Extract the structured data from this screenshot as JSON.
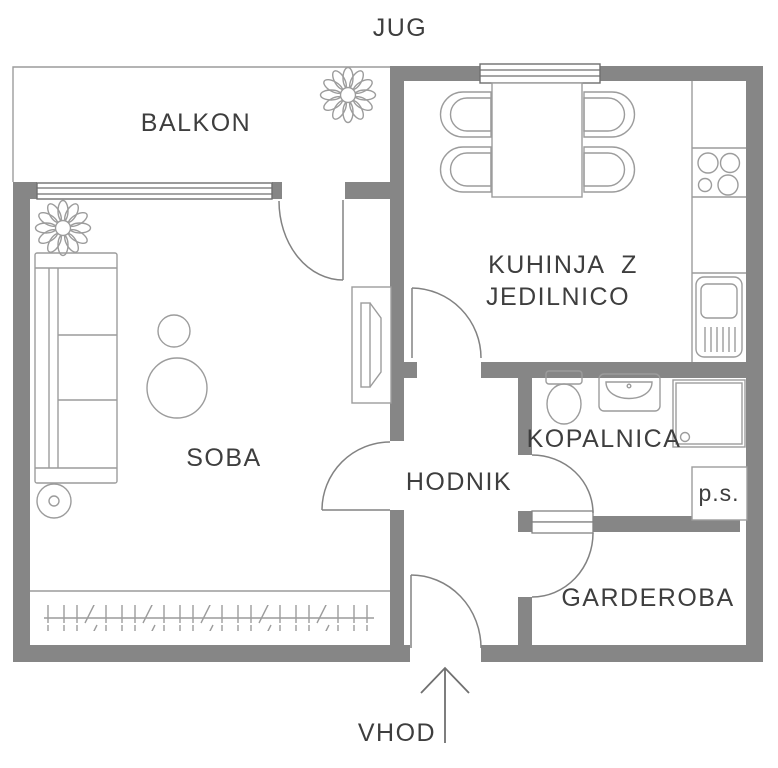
{
  "title": "Apartment floor plan",
  "compass": {
    "south_label": "JUG"
  },
  "entrance": {
    "label": "VHOD"
  },
  "rooms": {
    "balcony": {
      "label": "BALKON"
    },
    "kitchen": {
      "label_line1": "KUHINJA  Z",
      "label_line2": "JEDILNICO"
    },
    "living_room": {
      "label": "SOBA"
    },
    "hallway": {
      "label": "HODNIK"
    },
    "bathroom": {
      "label": "KOPALNICA"
    },
    "pantry_shaft": {
      "label": "p.s."
    },
    "wardrobe": {
      "label": "GARDEROBA"
    }
  },
  "colors": {
    "background": "#ffffff",
    "wall": "#868686",
    "furniture_line": "#9c9c9c",
    "door_line": "#828282",
    "window_line": "#6f6f6f",
    "text": "#3e3e3e"
  },
  "symbols": [
    "sofa",
    "coffee-table",
    "floor-lamp",
    "plant",
    "tv-cabinet",
    "radiator",
    "dining-table",
    "chair",
    "kitchen-counter",
    "stove",
    "kitchen-sink",
    "toilet",
    "washbasin",
    "shower",
    "door-swing",
    "window",
    "entrance-arrow"
  ]
}
